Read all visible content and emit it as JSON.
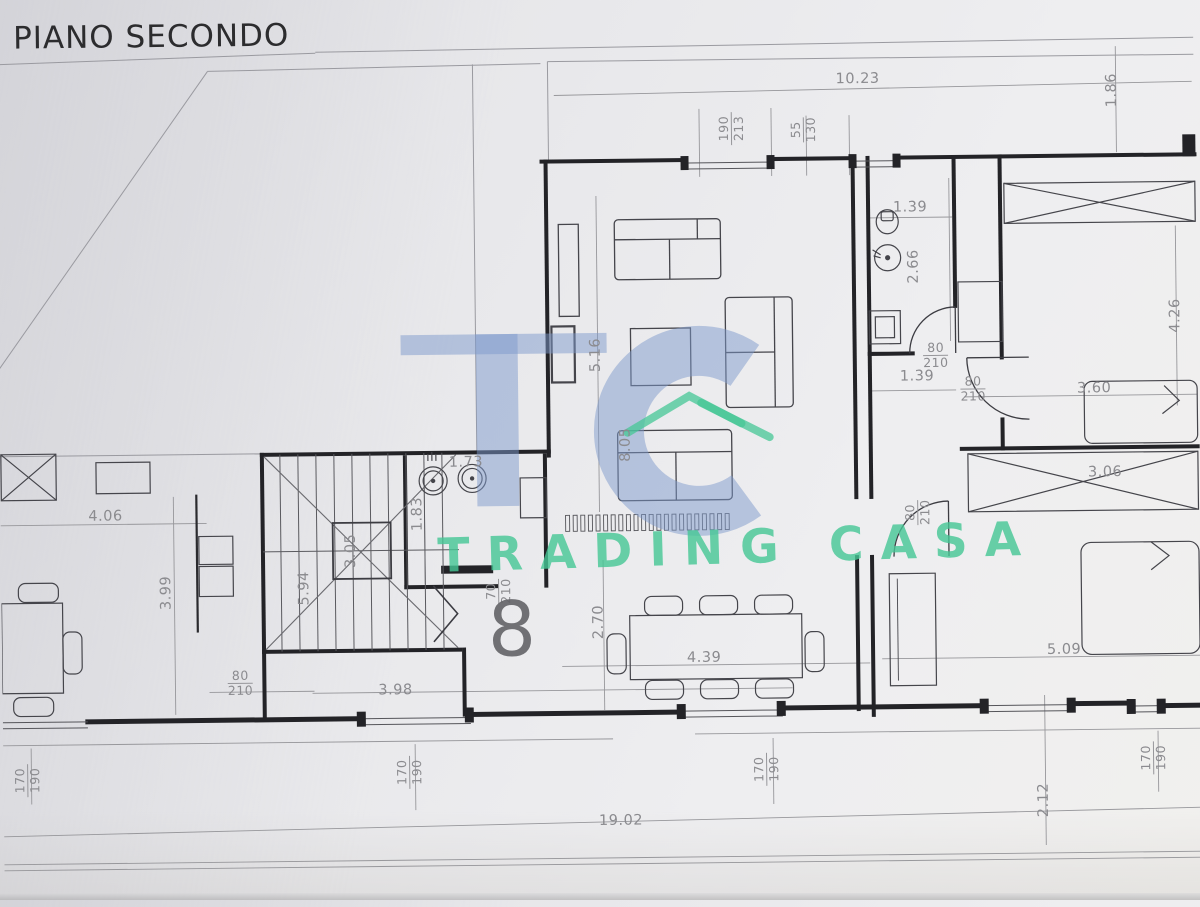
{
  "title": "PIANO SECONDO",
  "unit_number": "8",
  "watermark": {
    "name": "TRADING CASA",
    "blue": "#7e99cc",
    "green": "#45c795"
  },
  "colors": {
    "paper": "#e9e9eb",
    "wall_ink": "#232327",
    "furniture_ink": "#45454b",
    "dimension_gray": "#8b8b8f"
  },
  "dimension_labels": [
    {
      "text": "10.23",
      "x": 862,
      "y": 82,
      "rot": 0
    },
    {
      "text": "1.86",
      "x": 1116,
      "y": 96,
      "rot": -90
    },
    {
      "text": "1.39",
      "x": 913,
      "y": 211,
      "rot": 0
    },
    {
      "text": "2.66",
      "x": 916,
      "y": 270,
      "rot": -90
    },
    {
      "text": "4.26",
      "x": 1177,
      "y": 322,
      "rot": -90
    },
    {
      "text": "3.60",
      "x": 1095,
      "y": 394,
      "rot": 0
    },
    {
      "text": "3.06",
      "x": 1105,
      "y": 478,
      "rot": 0
    },
    {
      "text": "1.39",
      "x": 918,
      "y": 380,
      "rot": 0
    },
    {
      "text": "5.16",
      "x": 597,
      "y": 355,
      "rot": -90
    },
    {
      "text": "8.05",
      "x": 626,
      "y": 445,
      "rot": -90
    },
    {
      "text": "1.73",
      "x": 466,
      "y": 461,
      "rot": 0
    },
    {
      "text": "1.83",
      "x": 417,
      "y": 512,
      "rot": -90
    },
    {
      "text": "3.05",
      "x": 350,
      "y": 548,
      "rot": -90
    },
    {
      "text": "5.94",
      "x": 303,
      "y": 585,
      "rot": -90
    },
    {
      "text": "4.06",
      "x": 105,
      "y": 511,
      "rot": 0
    },
    {
      "text": "3.99",
      "x": 165,
      "y": 588,
      "rot": -90
    },
    {
      "text": "2.70",
      "x": 597,
      "y": 622,
      "rot": -90
    },
    {
      "text": "4.39",
      "x": 702,
      "y": 659,
      "rot": 0
    },
    {
      "text": "3.98",
      "x": 393,
      "y": 688,
      "rot": 0
    },
    {
      "text": "5.09",
      "x": 1062,
      "y": 655,
      "rot": 0
    },
    {
      "text": "19.02",
      "x": 617,
      "y": 821,
      "rot": 0
    },
    {
      "text": "2.12",
      "x": 1040,
      "y": 805,
      "rot": -90
    }
  ],
  "door_window_sizes": [
    {
      "top": "190",
      "bottom": "213",
      "x": 735,
      "y": 130,
      "rot": -90
    },
    {
      "top": "55",
      "bottom": "130",
      "x": 807,
      "y": 132,
      "rot": -90
    },
    {
      "top": "80",
      "bottom": "210",
      "x": 937,
      "y": 359,
      "rot": 0
    },
    {
      "top": "80",
      "bottom": "210",
      "x": 974,
      "y": 393,
      "rot": 0
    },
    {
      "top": "80",
      "bottom": "210",
      "x": 917,
      "y": 516,
      "rot": -90
    },
    {
      "top": "70",
      "bottom": "210",
      "x": 497,
      "y": 590,
      "rot": -90
    },
    {
      "top": "80",
      "bottom": "210",
      "x": 238,
      "y": 679,
      "rot": 0
    },
    {
      "top": "170",
      "bottom": "190",
      "x": 24,
      "y": 774,
      "rot": -90
    },
    {
      "top": "170",
      "bottom": "190",
      "x": 406,
      "y": 770,
      "rot": -90
    },
    {
      "top": "170",
      "bottom": "190",
      "x": 763,
      "y": 771,
      "rot": -90
    },
    {
      "top": "170",
      "bottom": "190",
      "x": 1150,
      "y": 764,
      "rot": -90
    }
  ]
}
